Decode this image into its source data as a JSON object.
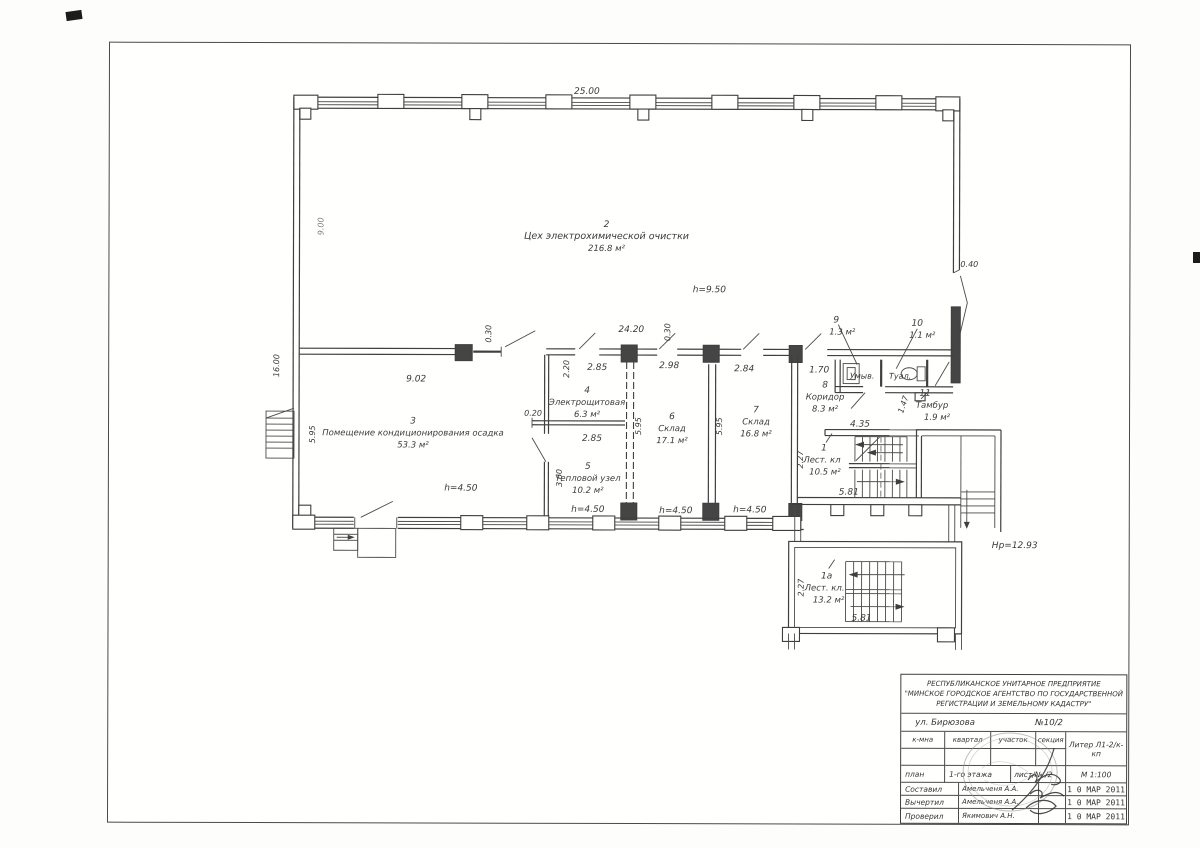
{
  "plan": {
    "rooms": {
      "r2": {
        "num": "2",
        "name": "Цех электрохимической очистки",
        "area": "216.8 м²"
      },
      "r3": {
        "num": "3",
        "name": "Помещение кондиционирования осадка",
        "area": "53.3 м²"
      },
      "r4": {
        "num": "4",
        "name": "Электрощитовая",
        "area": "6.3 м²"
      },
      "r5": {
        "num": "5",
        "name": "Тепловой узел",
        "area": "10.2 м²"
      },
      "r6": {
        "num": "6",
        "name": "Склад",
        "area": "17.1 м²"
      },
      "r7": {
        "num": "7",
        "name": "Склад",
        "area": "16.8 м²"
      },
      "r8": {
        "num": "8",
        "name": "Коридор",
        "area": "8.3 м²"
      },
      "r9": {
        "num": "9",
        "area": "1.3 м²",
        "label": "Умыв."
      },
      "r10": {
        "num": "10",
        "area": "1.1 м²",
        "label": "Туал."
      },
      "r11": {
        "num": "11",
        "name": "Тамбур",
        "area": "1.9 м²"
      },
      "r1": {
        "num": "1",
        "name": "Лест. кл",
        "area": "10.5 м²"
      },
      "r1a": {
        "num": "1а",
        "name": "Лест. кл.",
        "area": "13.2 м²"
      }
    },
    "dims": {
      "w_total": "25.00",
      "w_mid": "24.20",
      "h_left": "9.00",
      "h_left2": "16.00",
      "d040": "0.40",
      "d030": "0.30",
      "d902": "9.02",
      "d285": "2.85",
      "d220": "2.20",
      "d020": "0.20",
      "d360": "3.60",
      "d298": "2.98",
      "d284": "2.84",
      "d595": "5.95",
      "d170": "1.70",
      "d147": "1.47",
      "d435": "4.35",
      "d581": "5.81",
      "d227": "2.27",
      "h950": "h=9.50",
      "h450": "h=4.50",
      "hp": "Нр=12.93"
    }
  },
  "title_block": {
    "org_line1": "РЕСПУБЛИКАНСКОЕ УНИТАРНОЕ ПРЕДПРИЯТИЕ",
    "org_line2": "\"МИНСКОЕ ГОРОДСКОЕ АГЕНТСТВО ПО ГОСУДАРСТВЕННОЙ",
    "org_line3": "РЕГИСТРАЦИИ И ЗЕМЕЛЬНОМУ КАДАСТРУ\"",
    "street": "ул. Бирюзова",
    "number": "№10/2",
    "col1": "к-мна",
    "col2": "квартал",
    "col3": "участок",
    "col4": "секция",
    "liter": "Литер Л1-2/к-кп",
    "doc_type": "план",
    "doc_value": "1-го этажа",
    "sheet": "лист/№  /2",
    "scale": "М 1:100",
    "row1_role": "Составил",
    "row1_name": "Амельченя А.А.",
    "row1_date": "1 0 МАР 2011",
    "row2_role": "Вычертил",
    "row2_name": "Амельченя А.А.",
    "row2_date": "1 0 МАР 2011",
    "row3_role": "Проверил",
    "row3_name": "Якимович А.Н.",
    "row3_date": "1 0 МАР 2011"
  }
}
